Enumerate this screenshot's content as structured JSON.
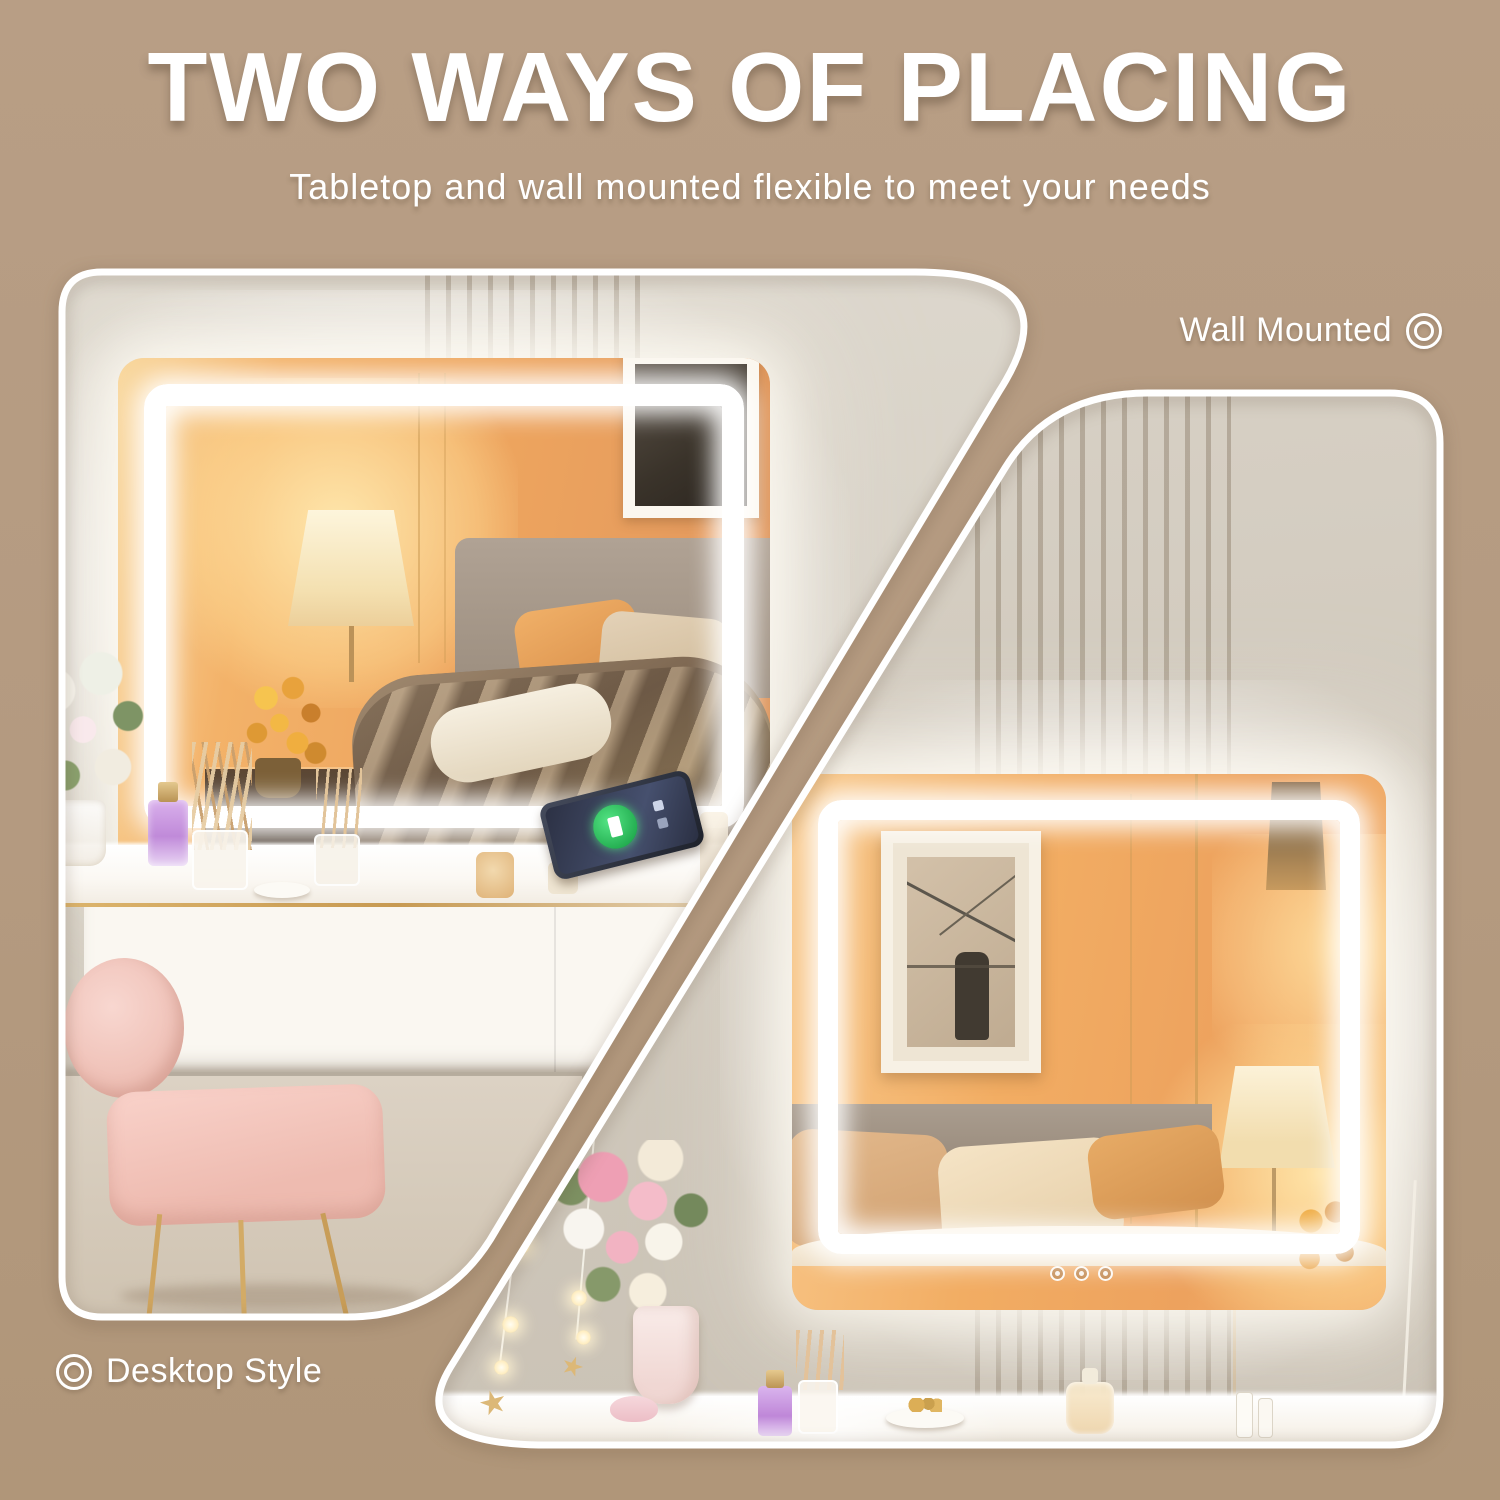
{
  "header": {
    "title": "TWO WAYS OF PLACING",
    "subtitle": "Tabletop and wall mounted flexible to meet your needs"
  },
  "labels": {
    "wall_mounted": "Wall Mounted",
    "desktop_style": "Desktop Style"
  },
  "icons": {
    "wall_mounted": "double-circle-target-icon",
    "desktop_style": "double-circle-target-icon"
  },
  "colors": {
    "background_tan": "#b49a80",
    "panel_border": "#ffffff",
    "led_glow": "#ffffff",
    "text": "#ffffff",
    "gold_accent": "#cda45f",
    "warm_reflection": "#efa763"
  }
}
